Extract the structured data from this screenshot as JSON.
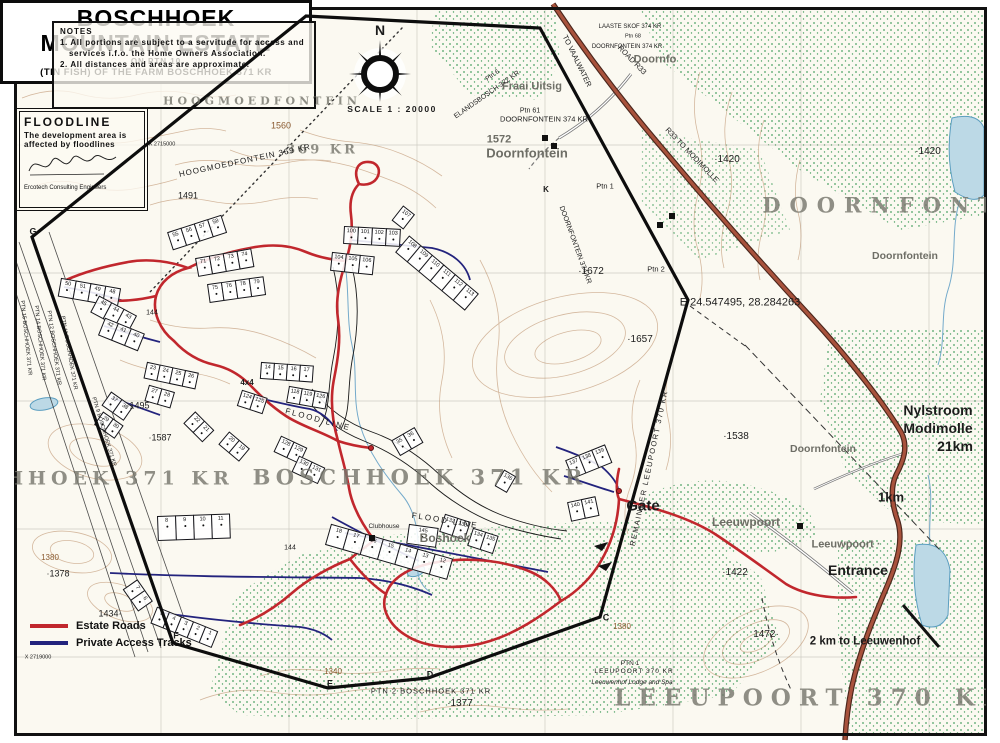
{
  "colors": {
    "paper": "#fbf9f1",
    "frame": "#111111",
    "boundary": "#0d0d0d",
    "estate_road": "#c1272d",
    "access_track": "#23237d",
    "main_road": "#a8523c",
    "contour": "#b5845c",
    "vegetation": "#4ba264",
    "water_fill": "#bcd9e6",
    "water_edge": "#5b9ec0",
    "big_name": "#78786c",
    "grid": "#8a8a7e"
  },
  "boxes": {
    "notes": {
      "title": "NOTES",
      "line1a": "1. All portions are subject to a servitude for access and",
      "line1b": "services i.f.o. the Home Owners Association.",
      "line2": "2. All distances and areas are approximate."
    },
    "floodline": {
      "title": "FLOODLINE",
      "body": "The development area is affected by floodlines",
      "firm": "Ercotech Consulting Engineers"
    },
    "title_block": {
      "l1": "BOSCHHOEK",
      "l2": "MOUNTAIN ESTATE",
      "l3": "ON PTN 10",
      "l4": "(TIN FISH) OF THE FARM BOSCHHOEK 371 KR"
    }
  },
  "legend": {
    "items": [
      {
        "label": "Estate Roads",
        "color": "#c1272d"
      },
      {
        "label": "Private Access Tracks",
        "color": "#23237d"
      }
    ]
  },
  "labels": [
    {
      "t": "N",
      "x": 380,
      "y": 30,
      "s": 14,
      "b": true
    },
    {
      "t": "SCALE 1 : 20000",
      "x": 392,
      "y": 109,
      "s": 8.5,
      "sp": 1.5,
      "b": true
    },
    {
      "t": "HOOGMOEDFONTEIN",
      "x": 262,
      "y": 101,
      "s": 11,
      "sp": 4,
      "c": "bigname"
    },
    {
      "t": "369 KR",
      "x": 322,
      "y": 150,
      "s": 13,
      "sp": 3,
      "c": "bigname"
    },
    {
      "t": "HOOGMOEDFONTEIN 369 KR",
      "x": 245,
      "y": 161,
      "s": 8,
      "r": -12,
      "sp": 1
    },
    {
      "t": "1560",
      "x": 281,
      "y": 126,
      "s": 9,
      "c": "brown"
    },
    {
      "t": "1491",
      "x": 188,
      "y": 196,
      "s": 9
    },
    {
      "t": "X 2715000",
      "x": 162,
      "y": 145,
      "s": 5.5
    },
    {
      "t": "X 2719000",
      "x": 38,
      "y": 658,
      "s": 5.5
    },
    {
      "t": "X 2718000",
      "x": 8,
      "y": 408,
      "s": 5.5,
      "r": -90
    },
    {
      "t": "Fraai Uitsig",
      "x": 532,
      "y": 87,
      "s": 11,
      "c": "gray2"
    },
    {
      "t": "ELANDSBOSCH 372 KR",
      "x": 487,
      "y": 95,
      "s": 7,
      "r": -35
    },
    {
      "t": "Ptn 6",
      "x": 493,
      "y": 76,
      "s": 6.5,
      "r": -35
    },
    {
      "t": "TO VAALWATER",
      "x": 577,
      "y": 61,
      "s": 7.5,
      "r": 64
    },
    {
      "t": "ROAD R33",
      "x": 632,
      "y": 60,
      "s": 7.5,
      "r": 46
    },
    {
      "t": "R33 TO MODIMOLLE",
      "x": 692,
      "y": 155,
      "s": 7.5,
      "r": 46
    },
    {
      "t": "LAASTE SKOF 374 KR",
      "x": 630,
      "y": 27,
      "s": 6
    },
    {
      "t": "Ptn 68",
      "x": 633,
      "y": 37,
      "s": 5.5
    },
    {
      "t": "DOORNFONTEIN 374 KR",
      "x": 627,
      "y": 47,
      "s": 6
    },
    {
      "t": "Doornfo",
      "x": 655,
      "y": 60,
      "s": 11,
      "c": "gray2"
    },
    {
      "t": "Ptn 61",
      "x": 530,
      "y": 111,
      "s": 7
    },
    {
      "t": "DOORNFONTEIN 374 KR",
      "x": 544,
      "y": 119,
      "s": 7.5
    },
    {
      "t": "1572",
      "x": 499,
      "y": 140,
      "s": 11,
      "c": "gray2"
    },
    {
      "t": "Doornfontein",
      "x": 527,
      "y": 153,
      "s": 13,
      "c": "gray2"
    },
    {
      "t": "Ptn 1",
      "x": 605,
      "y": 186,
      "s": 7.5
    },
    {
      "t": "DOORNFONTEIN 374 KR",
      "x": 575,
      "y": 245,
      "s": 7,
      "r": 70
    },
    {
      "t": "Ptn 2",
      "x": 656,
      "y": 269,
      "s": 7.5
    },
    {
      "t": "·1672",
      "x": 591,
      "y": 272,
      "s": 10
    },
    {
      "t": "·1420",
      "x": 727,
      "y": 160,
      "s": 10
    },
    {
      "t": "·1420",
      "x": 928,
      "y": 152,
      "s": 10
    },
    {
      "t": "DOORNFONTE",
      "x": 895,
      "y": 205,
      "s": 21,
      "sp": 9,
      "c": "bigname"
    },
    {
      "t": "Doornfontein",
      "x": 905,
      "y": 256,
      "s": 10.5,
      "c": "gray2"
    },
    {
      "t": "K",
      "x": 546,
      "y": 190,
      "s": 8,
      "b": true
    },
    {
      "t": "E 24.547495, 28.284263",
      "x": 740,
      "y": 303,
      "s": 11
    },
    {
      "t": "·1657",
      "x": 640,
      "y": 340,
      "s": 10
    },
    {
      "t": "·1538",
      "x": 736,
      "y": 437,
      "s": 10
    },
    {
      "t": "Doornfontein",
      "x": 823,
      "y": 449,
      "s": 10.5,
      "c": "gray2"
    },
    {
      "t": "Nylstroom",
      "x": 938,
      "y": 410,
      "s": 14,
      "b": true
    },
    {
      "t": "Modimolle",
      "x": 938,
      "y": 428,
      "s": 14,
      "b": true
    },
    {
      "t": "21km",
      "x": 955,
      "y": 446,
      "s": 14,
      "b": true
    },
    {
      "t": "1km",
      "x": 891,
      "y": 497,
      "s": 13,
      "b": true
    },
    {
      "t": "REMAINDER  LEEUPOORT  370 KR",
      "x": 649,
      "y": 468,
      "s": 7.5,
      "sp": 1.5,
      "r": -78
    },
    {
      "t": "Gate",
      "x": 643,
      "y": 506,
      "s": 15,
      "b": true
    },
    {
      "t": "Leeuwpoort",
      "x": 746,
      "y": 522,
      "s": 12,
      "c": "gray2"
    },
    {
      "t": "Leeuwpoort ·",
      "x": 846,
      "y": 545,
      "s": 11,
      "c": "gray2"
    },
    {
      "t": "Entrance",
      "x": 858,
      "y": 570,
      "s": 14,
      "b": true
    },
    {
      "t": "·1422",
      "x": 735,
      "y": 573,
      "s": 10
    },
    {
      "t": "1472·",
      "x": 766,
      "y": 635,
      "s": 10
    },
    {
      "t": "2 km to Leeuwenhof",
      "x": 865,
      "y": 642,
      "s": 11.5,
      "b": true
    },
    {
      "t": "1380",
      "x": 622,
      "y": 627,
      "s": 8,
      "c": "brown"
    },
    {
      "t": "PTN 1",
      "x": 630,
      "y": 664,
      "s": 6.5
    },
    {
      "t": "LEEUPOORT 370 KR",
      "x": 634,
      "y": 672,
      "s": 6.5,
      "sp": 1
    },
    {
      "t": "Leeuwenhof Lodge and Spa",
      "x": 632,
      "y": 683,
      "s": 6.5,
      "i": true
    },
    {
      "t": "LEEUPOORT  370  KR",
      "x": 812,
      "y": 698,
      "s": 23,
      "sp": 8,
      "c": "bigname"
    },
    {
      "t": "PTN 2 BOSCHHOEK 371 KR",
      "x": 431,
      "y": 691,
      "s": 7.5,
      "sp": 1
    },
    {
      "t": "·1377",
      "x": 460,
      "y": 704,
      "s": 10
    },
    {
      "t": "1340",
      "x": 333,
      "y": 672,
      "s": 8,
      "c": "brown"
    },
    {
      "t": "E",
      "x": 330,
      "y": 684,
      "s": 9,
      "b": true
    },
    {
      "t": "D",
      "x": 430,
      "y": 675,
      "s": 9,
      "b": true
    },
    {
      "t": "C",
      "x": 606,
      "y": 618,
      "s": 9,
      "b": true
    },
    {
      "t": "F",
      "x": 176,
      "y": 636,
      "s": 9,
      "b": true
    },
    {
      "t": "G",
      "x": 33,
      "y": 232,
      "s": 9,
      "b": true
    },
    {
      "t": "BOSCHHOEK  371  KR",
      "x": 420,
      "y": 477,
      "s": 21,
      "sp": 5,
      "c": "bigname"
    },
    {
      "t": "SCHHOEK  371  KR",
      "x": 100,
      "y": 479,
      "s": 19,
      "sp": 5,
      "c": "bigname"
    },
    {
      "t": "·1587",
      "x": 160,
      "y": 438,
      "s": 9
    },
    {
      "t": "·1495",
      "x": 138,
      "y": 406,
      "s": 9
    },
    {
      "t": "144",
      "x": 152,
      "y": 313,
      "s": 7
    },
    {
      "t": "144",
      "x": 290,
      "y": 548,
      "s": 7
    },
    {
      "t": "4x4",
      "x": 247,
      "y": 383,
      "s": 8,
      "b": true
    },
    {
      "t": "FLOOD LINE",
      "x": 318,
      "y": 420,
      "s": 8,
      "sp": 2,
      "r": 15
    },
    {
      "t": "FLOOD LINE",
      "x": 445,
      "y": 521,
      "s": 8,
      "sp": 2,
      "r": 9
    },
    {
      "t": "Clubhouse",
      "x": 384,
      "y": 527,
      "s": 6.5
    },
    {
      "t": "Boshoek",
      "x": 445,
      "y": 538,
      "s": 12,
      "c": "gray2"
    },
    {
      "t": "1380",
      "x": 50,
      "y": 558,
      "s": 8,
      "c": "brown"
    },
    {
      "t": "·1378",
      "x": 58,
      "y": 574,
      "s": 9
    },
    {
      "t": "1434·",
      "x": 110,
      "y": 614,
      "s": 9
    },
    {
      "t": "PTN 15 BOSCHHOEK 371 KR",
      "x": 25,
      "y": 338,
      "s": 5.5,
      "r": 84
    },
    {
      "t": "PTN 14 BOSCHHOEK 371 KR",
      "x": 39,
      "y": 343,
      "s": 5.5,
      "r": 84
    },
    {
      "t": "PTN 12 BOSCHHOEK 371 KR",
      "x": 53,
      "y": 348,
      "s": 5.5,
      "r": 82
    },
    {
      "t": "PTN 11 BOSCHHOEK 371 KR",
      "x": 68,
      "y": 353,
      "s": 5.5,
      "r": 80
    },
    {
      "t": "PTN 9 BOSCHHOEK 371 KR",
      "x": 103,
      "y": 432,
      "s": 5.5,
      "r": 73
    }
  ],
  "plot_clusters": [
    {
      "x": 62,
      "y": 278,
      "rot": 10,
      "w": 16,
      "h": 19,
      "nums": [
        "50",
        "51",
        "49",
        "48"
      ]
    },
    {
      "x": 100,
      "y": 296,
      "rot": 28,
      "w": 15,
      "h": 19,
      "nums": [
        "45",
        "44",
        "43"
      ]
    },
    {
      "x": 106,
      "y": 318,
      "rot": 22,
      "w": 15,
      "h": 19,
      "nums": [
        "42",
        "41",
        "40"
      ]
    },
    {
      "x": 168,
      "y": 232,
      "rot": -18,
      "w": 15,
      "h": 19,
      "nums": [
        "55",
        "56",
        "57",
        "58"
      ]
    },
    {
      "x": 196,
      "y": 258,
      "rot": -10,
      "w": 15,
      "h": 19,
      "nums": [
        "71",
        "72",
        "73",
        "74"
      ]
    },
    {
      "x": 208,
      "y": 284,
      "rot": -8,
      "w": 15,
      "h": 19,
      "nums": [
        "75",
        "76",
        "78",
        "79"
      ]
    },
    {
      "x": 345,
      "y": 226,
      "rot": 3,
      "w": 15,
      "h": 18,
      "nums": [
        "100",
        "101",
        "102",
        "103"
      ]
    },
    {
      "x": 333,
      "y": 252,
      "rot": 6,
      "w": 15,
      "h": 19,
      "nums": [
        "104",
        "105",
        "106"
      ]
    },
    {
      "x": 404,
      "y": 206,
      "rot": 38,
      "w": 15,
      "h": 19,
      "nums": [
        "107"
      ]
    },
    {
      "x": 410,
      "y": 236,
      "rot": 40,
      "w": 16,
      "h": 22,
      "nums": [
        "108",
        "109",
        "110",
        "111",
        "112",
        "113"
      ]
    },
    {
      "x": 262,
      "y": 362,
      "rot": 4,
      "w": 14,
      "h": 17,
      "nums": [
        "14",
        "15",
        "16",
        "17"
      ]
    },
    {
      "x": 290,
      "y": 386,
      "rot": 10,
      "w": 14,
      "h": 17,
      "nums": [
        "118",
        "119",
        "126"
      ]
    },
    {
      "x": 243,
      "y": 390,
      "rot": 18,
      "w": 14,
      "h": 17,
      "nums": [
        "124",
        "125"
      ]
    },
    {
      "x": 148,
      "y": 362,
      "rot": 12,
      "w": 14,
      "h": 17,
      "nums": [
        "23",
        "24",
        "25",
        "26"
      ]
    },
    {
      "x": 150,
      "y": 385,
      "rot": 16,
      "w": 14,
      "h": 17,
      "nums": [
        "27",
        "28"
      ]
    },
    {
      "x": 196,
      "y": 412,
      "rot": 45,
      "w": 14,
      "h": 17,
      "nums": [
        "22",
        "21"
      ]
    },
    {
      "x": 230,
      "y": 432,
      "rot": 40,
      "w": 14,
      "h": 17,
      "nums": [
        "20",
        "19"
      ]
    },
    {
      "x": 112,
      "y": 392,
      "rot": 35,
      "w": 14,
      "h": 17,
      "nums": [
        "37",
        "38"
      ]
    },
    {
      "x": 104,
      "y": 412,
      "rot": 35,
      "w": 13,
      "h": 16,
      "nums": [
        "29",
        "30"
      ]
    },
    {
      "x": 282,
      "y": 436,
      "rot": 25,
      "w": 15,
      "h": 18,
      "nums": [
        "128",
        "129"
      ]
    },
    {
      "x": 300,
      "y": 456,
      "rot": 25,
      "w": 15,
      "h": 18,
      "nums": [
        "130",
        "131"
      ]
    },
    {
      "x": 392,
      "y": 440,
      "rot": -30,
      "w": 14,
      "h": 18,
      "nums": [
        "35",
        "36"
      ]
    },
    {
      "x": 446,
      "y": 514,
      "rot": 18,
      "w": 14,
      "h": 19,
      "nums": [
        "132",
        "133"
      ]
    },
    {
      "x": 474,
      "y": 528,
      "rot": 18,
      "w": 14,
      "h": 19,
      "nums": [
        "134",
        "135"
      ]
    },
    {
      "x": 505,
      "y": 470,
      "rot": 30,
      "w": 14,
      "h": 19,
      "nums": [
        "136"
      ]
    },
    {
      "x": 566,
      "y": 460,
      "rot": -22,
      "w": 15,
      "h": 20,
      "nums": [
        "137",
        "138",
        "139"
      ]
    },
    {
      "x": 568,
      "y": 502,
      "rot": -12,
      "w": 15,
      "h": 20,
      "nums": [
        "140",
        "141"
      ]
    },
    {
      "x": 158,
      "y": 516,
      "rot": -2,
      "w": 19,
      "h": 25,
      "nums": [
        "8",
        "9",
        "10",
        "11"
      ]
    },
    {
      "x": 332,
      "y": 524,
      "rot": 16,
      "w": 19,
      "h": 22,
      "nums": [
        "18",
        "17",
        "16",
        "15",
        "14",
        "13",
        "12"
      ]
    },
    {
      "x": 138,
      "y": 580,
      "rot": 55,
      "w": 14,
      "h": 18,
      "nums": [
        "7",
        "6"
      ]
    },
    {
      "x": 158,
      "y": 607,
      "rot": 22,
      "w": 14,
      "h": 18,
      "nums": [
        "5",
        "4",
        "3",
        "2",
        "1"
      ]
    },
    {
      "x": 410,
      "y": 524,
      "rot": 8,
      "w": 30,
      "h": 20,
      "nums": [
        "145"
      ]
    }
  ],
  "buildings": [
    [
      545,
      138
    ],
    [
      554,
      146
    ],
    [
      672,
      216
    ],
    [
      660,
      225
    ],
    [
      800,
      526
    ],
    [
      372,
      538
    ]
  ],
  "red_dots": [
    [
      619,
      491
    ],
    [
      371,
      448
    ]
  ]
}
